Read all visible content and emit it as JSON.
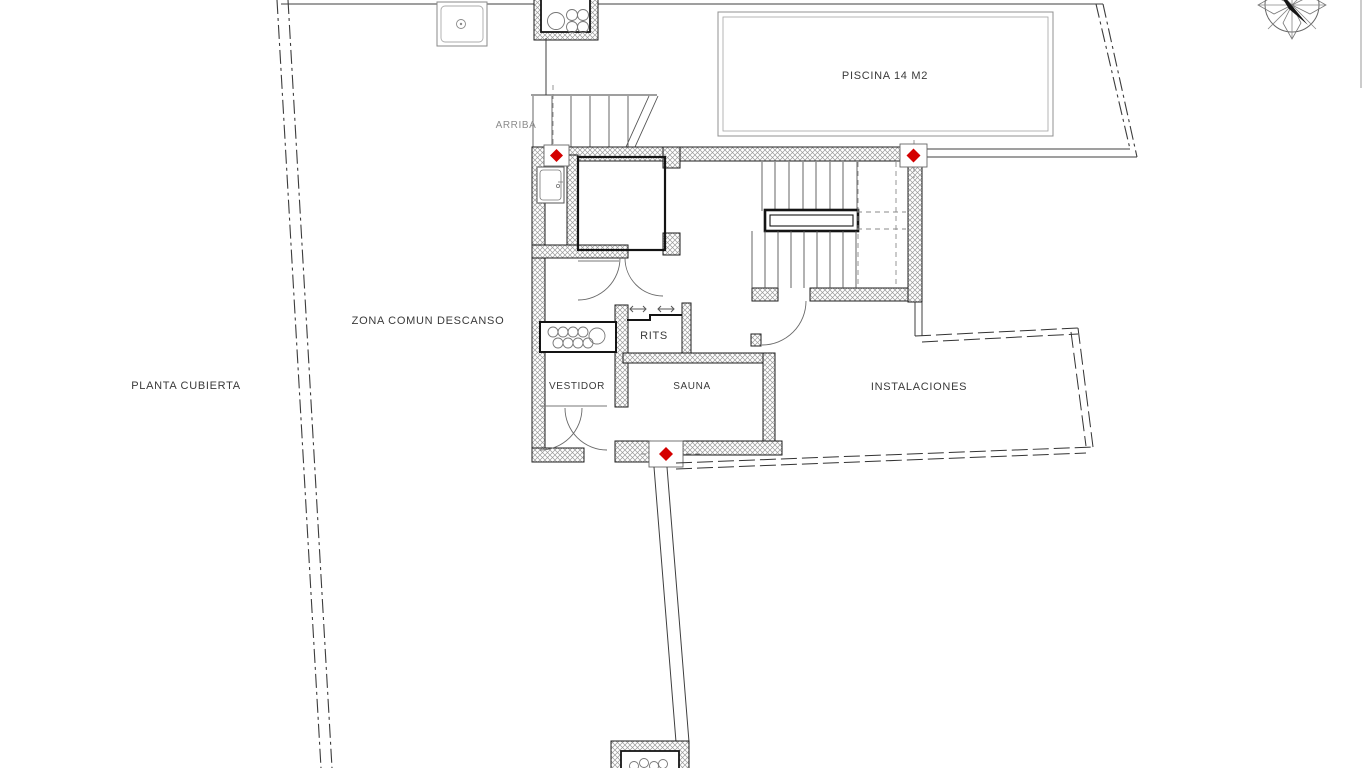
{
  "plan": {
    "title": "PLANTA CUBIERTA",
    "labels": {
      "piscina": "PISCINA 14 M2",
      "zona_comun": "ZONA COMUN DESCANSO",
      "planta": "PLANTA CUBIERTA",
      "arriba": "ARRIBA",
      "rits": "RITS",
      "vestidor": "VESTIDOR",
      "sauna": "SAUNA",
      "instalaciones": "INSTALACIONES"
    },
    "markers": {
      "count": 3,
      "shape": "diamond"
    },
    "icons": {
      "compass": "north-compass-icon",
      "marker": "level-marker-diamond-icon"
    }
  },
  "colors": {
    "marker_red": "#d40000",
    "wall_line": "#1c1c1c",
    "hatch_gray": "#9a9a9a",
    "text_dark": "#3a3a3a",
    "text_muted": "#8c8c8c",
    "background": "#ffffff"
  }
}
